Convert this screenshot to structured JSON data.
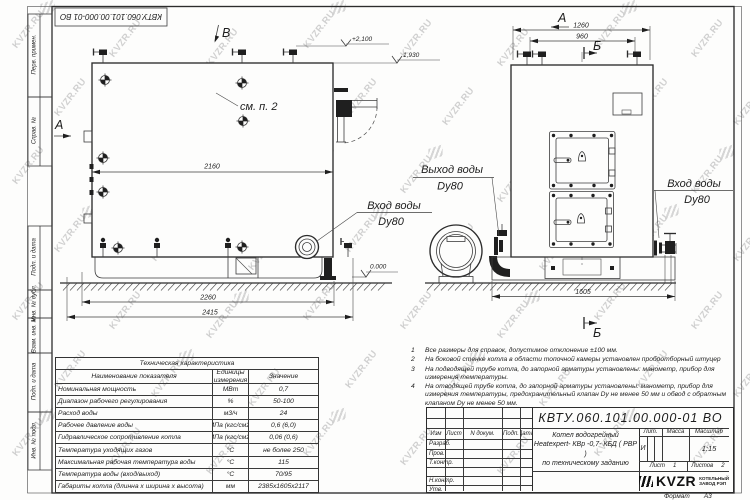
{
  "watermark": {
    "text": "KVZR.RU"
  },
  "stamp": {
    "doc_number": "КВТУ.060.101.00.000-01 ВО"
  },
  "margin_labels": [
    "Перв. примен.",
    "Справ. №",
    "Подп. и дата",
    "Инв. № дубл.",
    "Взам. инв. №",
    "Подп. и дата",
    "Инв. № подл."
  ],
  "drawing": {
    "view_labels": {
      "a_left": "А",
      "b_view": "В",
      "a_right": "А",
      "b_sec_top": "Б",
      "b_sec_bot": "Б"
    },
    "dims": {
      "d2160": "2160",
      "d2260": "2260",
      "d2415": "2415",
      "d1260": "1260",
      "d960": "960",
      "d1605": "1605"
    },
    "elevations": {
      "plus2100": "+2,100",
      "e1930": "1,930",
      "zero": "0.000"
    },
    "callouts": {
      "see_item": "см. п. 2",
      "inlet_side": "Вход воды",
      "inlet_side_dn": "Dy80",
      "outlet": "Выход воды",
      "outlet_dn": "Dy80",
      "inlet_front": "Вход воды",
      "inlet_front_dn": "Dy80"
    }
  },
  "table": {
    "title": "Техническая характеристика",
    "headers": {
      "name": "Наименование показателя",
      "unit": "Единицы измерения",
      "value": "Значение"
    },
    "rows": [
      {
        "name": "Номинальная мощность",
        "unit": "МВт",
        "value": "0,7"
      },
      {
        "name": "Диапазон рабочего регулирования",
        "unit": "%",
        "value": "50-100"
      },
      {
        "name": "Расход воды",
        "unit": "м3/ч",
        "value": "24"
      },
      {
        "name": "Рабочее давление воды",
        "unit": "МПа (кгс/см2)",
        "value": "0,6 (6,0)"
      },
      {
        "name": "Гидравлическое сопротивление котла",
        "unit": "МПа (кгс/см2)",
        "value": "0,06 (0,6)"
      },
      {
        "name": "Температура уходящих газов",
        "unit": "°С",
        "value": "не более 250"
      },
      {
        "name": "Максимальная рабочая температура воды",
        "unit": "°С",
        "value": "115"
      },
      {
        "name": "Температура воды (вход/выход)",
        "unit": "°С",
        "value": "70/95"
      },
      {
        "name": "Габариты котла (длинна х ширина х высота)",
        "unit": "мм",
        "value": "2385х1605х2117"
      }
    ]
  },
  "notes": [
    {
      "num": "1",
      "text": "Все размеры для справок, допустимое отклонение  ±100 мм."
    },
    {
      "num": "2",
      "text": "На боковой стенке котла в области топочной камеры установлен пробоотборный штуцер"
    },
    {
      "num": "3",
      "text": "На  подводящей трубе котла, до запорной арматуры установлены: манометр, прибор для измерения температуры."
    },
    {
      "num": "4",
      "text": "На отводящей трубе котла, до запорной арматуры установлены: манометр, прибор для измерения температуры, предохранительный клапан  Dу не менее  50 мм и обвод с обратным клапаном  Dу не менее  50 мм."
    }
  ],
  "titleblock": {
    "doc_number": "КВТУ.060.101.00.000-01 ВО",
    "product_line1": "Котел водогрейный",
    "product_line2": "Heatexpert- КВр -0,7- КБД ( РВР )",
    "product_line3": "по техническому заданию",
    "header_cols": {
      "izm": "Изм",
      "list": "Лист",
      "doc": "N докум.",
      "sign": "Подп.",
      "date": "Дата"
    },
    "row_labels": {
      "dev": "Разраб.",
      "check": "Пров.",
      "tcontr": "Т.контр.",
      "ncontr": "Н.контр.",
      "approve": "Утв."
    },
    "lit_label": "Лит.",
    "mass_label": "Масса",
    "scale_label": "Масштаб",
    "lit_value": "И",
    "scale_value": "1:15",
    "sheet_label": "Лист",
    "sheet_value": "1",
    "sheets_label": "Листов",
    "sheets_value": "2",
    "logo_text": "KVZR",
    "logo_line1": "КОТЕЛЬНЫЙ",
    "logo_line2": "ЗАВОД РЭП",
    "format_label": "Формат",
    "format_value": "А3"
  }
}
